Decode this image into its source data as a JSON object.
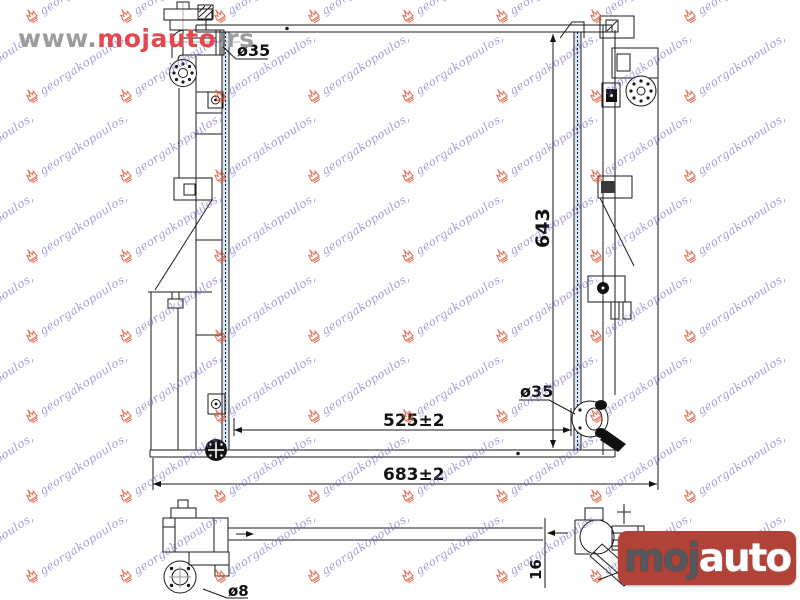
{
  "page": {
    "background": "#ffffff"
  },
  "header": {
    "url": {
      "prefix": "www.",
      "brand": "mojauto",
      "suffix": ".rs",
      "prefix_color": "#9c9c9c",
      "brand_color": "#e2484e"
    }
  },
  "logo": {
    "text_primary": "moj",
    "text_secondary": "auto",
    "background_color": "#b04238",
    "primary_color": "#54585c",
    "secondary_color": "#ffffff"
  },
  "watermark": {
    "text": "georgakopoulos,",
    "text_color": "#6e5cbe",
    "crown_color": "#d8502f"
  },
  "drawing": {
    "type": "radiator-technical-diagram",
    "labels": {
      "inlet_diameter": "ø35",
      "outlet_diameter": "ø35",
      "core_height": "643",
      "core_width": "525±2",
      "overall_width": "683±2",
      "drain_diameter": "ø8",
      "core_thickness": "16"
    },
    "colors": {
      "line": "#1a1a1a",
      "fin_tint": "#d9e8f5"
    }
  }
}
